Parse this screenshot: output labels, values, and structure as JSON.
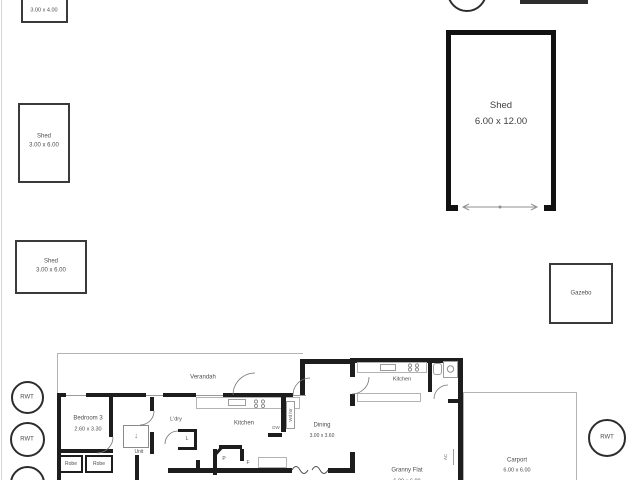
{
  "plan": {
    "box_small": {
      "dims": "3.00 x 4.00"
    },
    "shed_upper": {
      "name": "Shed",
      "dims": "3.00 x 6.00"
    },
    "shed_lower": {
      "name": "Shed",
      "dims": "3.00 x 6.00"
    },
    "shed_large": {
      "name": "Shed",
      "dims": "6.00 x 12.00"
    },
    "gazebo": {
      "name": "Gazebo"
    },
    "tanks": {
      "left_top": "RWT",
      "left_mid": "RWT",
      "right": "RWT"
    },
    "house": {
      "verandah": "Verandah",
      "bedroom3": {
        "name": "Bedroom 3",
        "dims": "2.60 x 3.30"
      },
      "robe1": "Robe",
      "robe2": "Robe",
      "unit": "Unit",
      "laundry": "L'dry",
      "linen": "L",
      "kitchen": "Kitchen",
      "pantry": "P",
      "fridge": "F",
      "dishwasher": "DW",
      "wood_heater": "Wd htr",
      "dining": {
        "name": "Dining",
        "dims": "3.00 x 3.60"
      }
    },
    "granny_flat": {
      "name": "Granny Flat",
      "dims": "6.00 x 6.00",
      "kitchen": "Kitchen",
      "ac": "AC"
    },
    "carport": {
      "name": "Carport",
      "dims": "6.00 x 6.00"
    }
  },
  "colors": {
    "wall": "#1d1d1d",
    "thin_line": "#b3b3b3",
    "text": "#4d4d4d"
  }
}
